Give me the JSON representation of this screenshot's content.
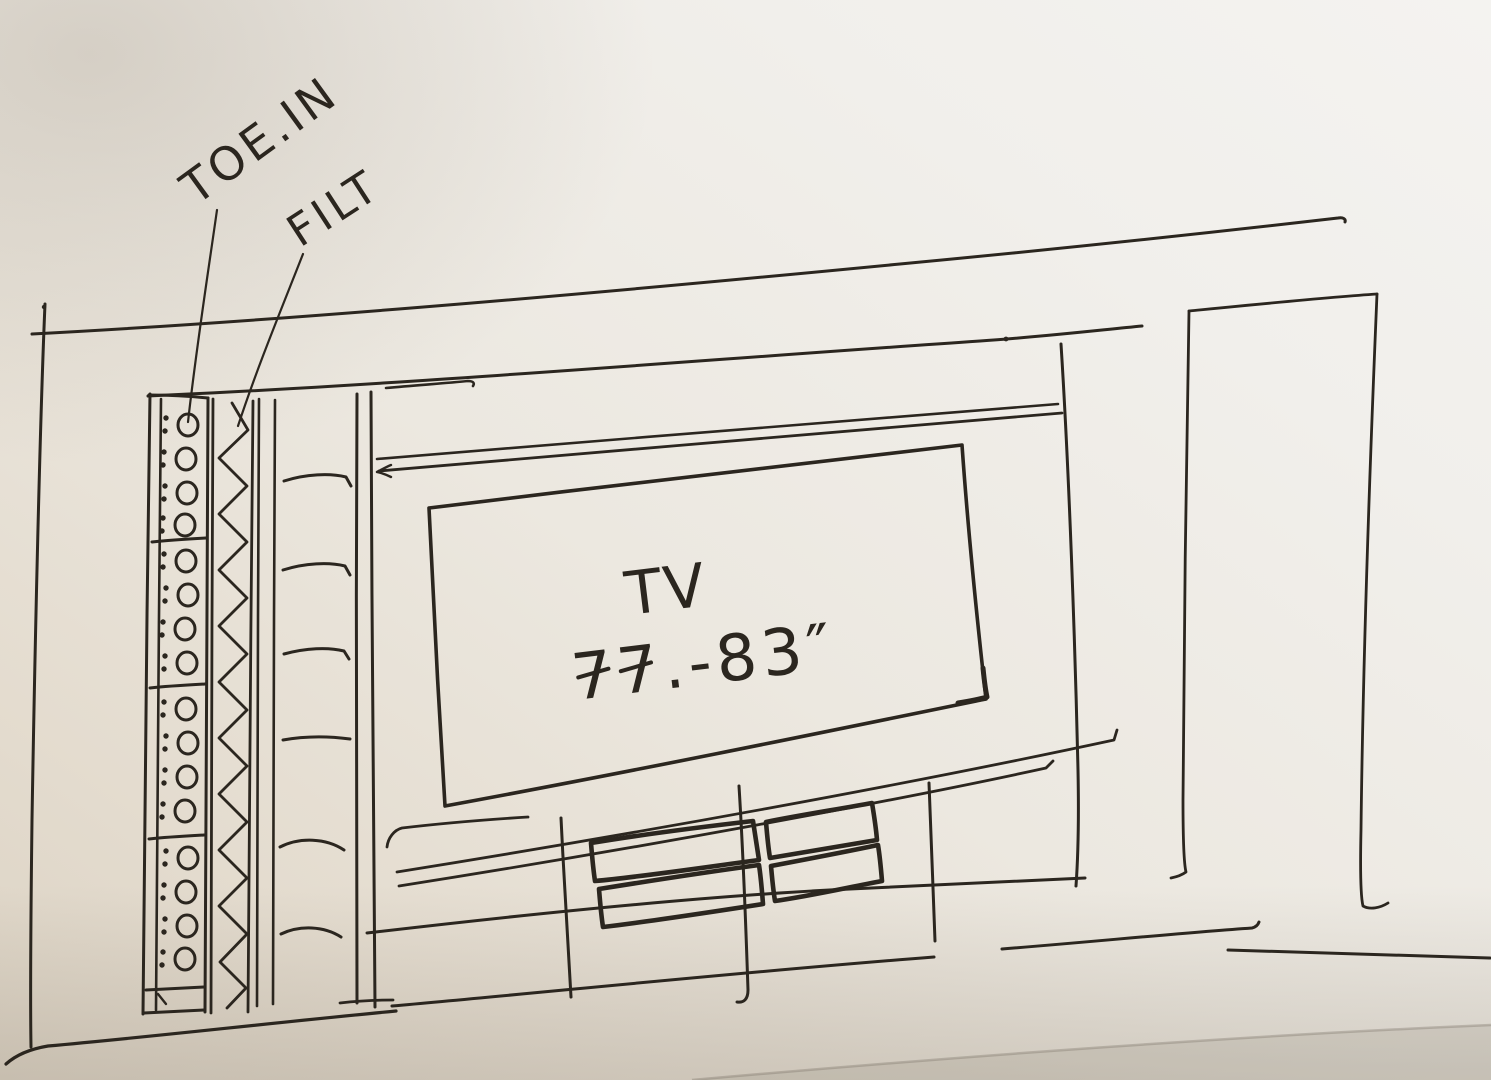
{
  "labels": {
    "toe_in": "TOE.IN",
    "filt": "FILT",
    "tv": "TV",
    "tv_size": "77.-83″"
  },
  "colors": {
    "ink": "#2b261f",
    "paper_light": "#f4f3f0",
    "paper_dark": "#dcd3c4"
  }
}
